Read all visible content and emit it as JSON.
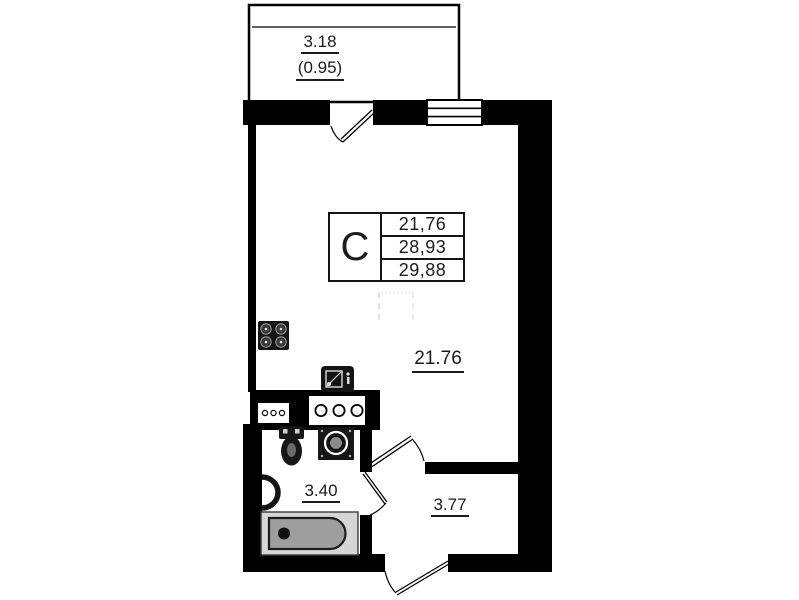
{
  "unit_table": {
    "type_label": "C",
    "rows": [
      "21,76",
      "28,93",
      "29,88"
    ]
  },
  "labels": {
    "balcony_area": "3.18",
    "balcony_reduced_area": "(0.95)",
    "living_area": "21.76",
    "bathroom_area": "3.40",
    "hallway_area": "3.77"
  },
  "icons": [
    "window-icon",
    "balcony-door-swing-icon",
    "room-door-swing-icon",
    "bathroom-door-swing-icon",
    "entrance-door-swing-icon",
    "stove-icon",
    "kitchen-sink-icon",
    "vent-duct-small-icon",
    "vent-duct-large-icon",
    "toilet-icon",
    "washing-machine-icon",
    "wash-basin-icon",
    "bathtub-icon"
  ],
  "colors": {
    "wall": "#000000",
    "background": "#ffffff",
    "line": "#141414",
    "bathtub_inner": "#9e9e9e",
    "bathtub_rim": "#d6d6d6"
  }
}
